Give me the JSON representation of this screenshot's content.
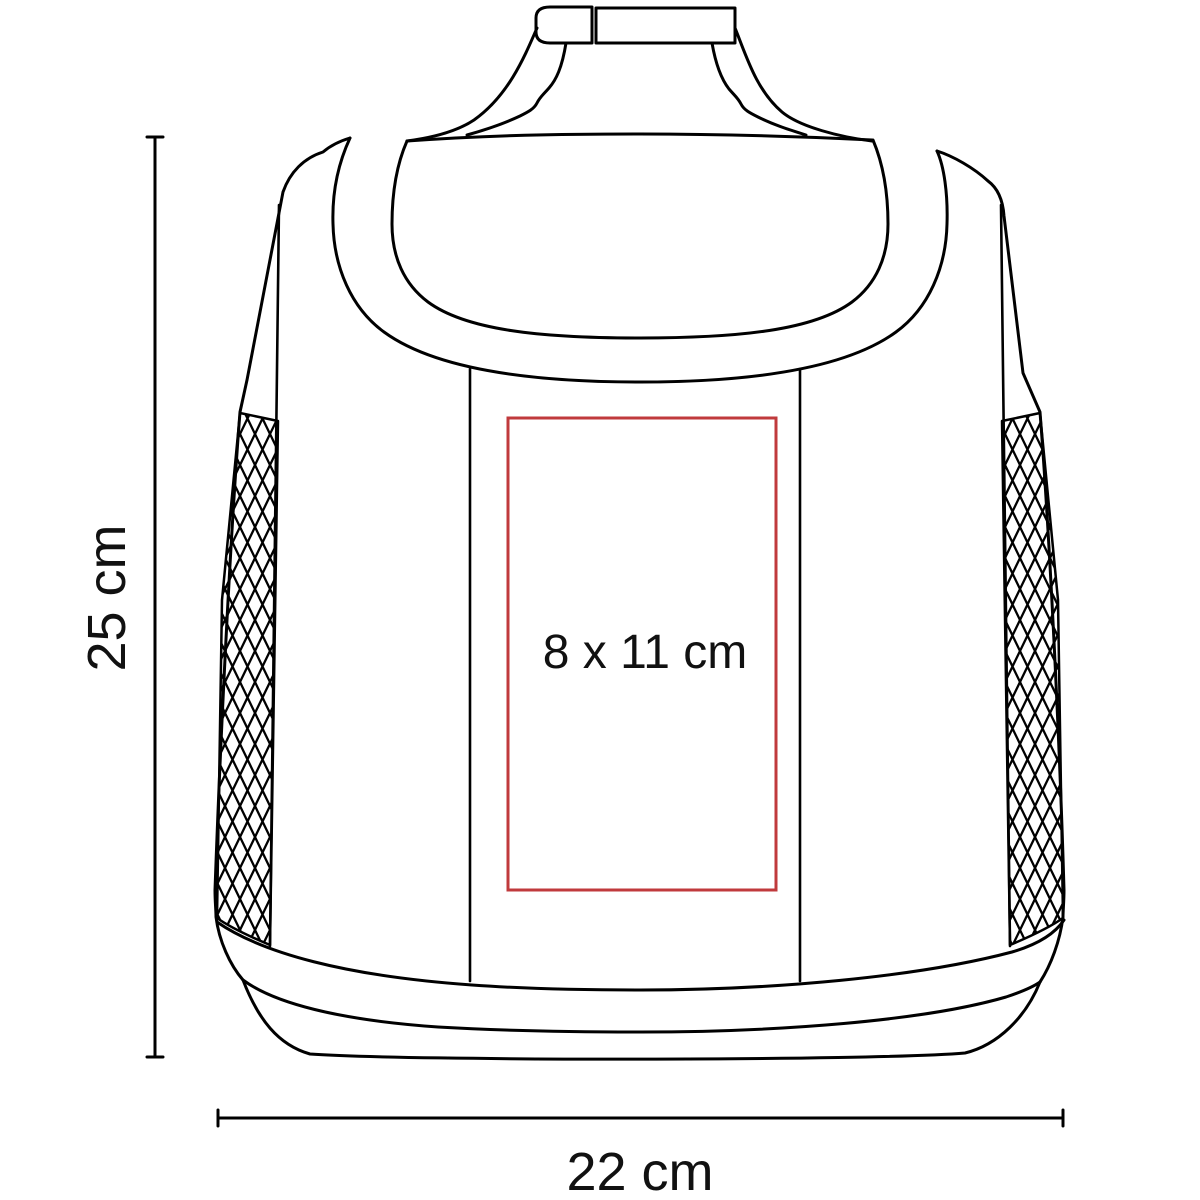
{
  "diagram": {
    "subject": "insulated cooler bag line drawing with imprint area",
    "height_label": "25 cm",
    "width_label": "22 cm",
    "print_area_label": "8 x 11 cm",
    "colors": {
      "outline": "#000000",
      "print_area_border": "#c03a3c",
      "label_text": "#111111",
      "background": "#ffffff"
    }
  }
}
